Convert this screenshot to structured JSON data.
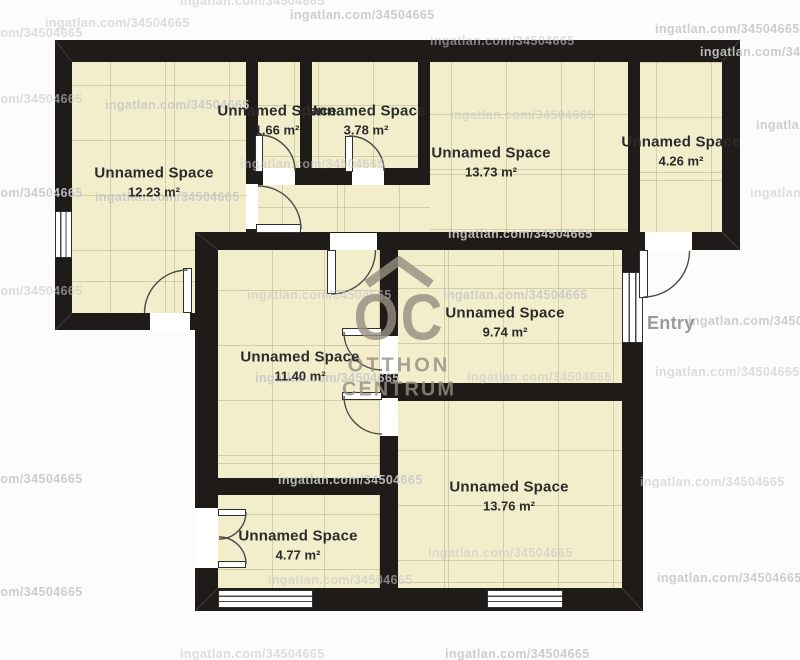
{
  "floorplan": {
    "entry_label": "Entry",
    "logo": {
      "monogram": "OC",
      "word1": "OTTHON",
      "word2": "CENTRUM"
    },
    "watermark": {
      "text": "ingatlan.com/34504665",
      "positions": [
        [
          180,
          -6
        ],
        [
          290,
          8
        ],
        [
          45,
          16
        ],
        [
          655,
          22
        ],
        [
          430,
          34
        ],
        [
          700,
          45
        ],
        [
          -62,
          26
        ],
        [
          105,
          98
        ],
        [
          450,
          108
        ],
        [
          756,
          118
        ],
        [
          -62,
          92
        ],
        [
          95,
          190
        ],
        [
          750,
          186
        ],
        [
          -62,
          186
        ],
        [
          240,
          157
        ],
        [
          448,
          227
        ],
        [
          247,
          288
        ],
        [
          443,
          288
        ],
        [
          -62,
          284
        ],
        [
          255,
          371
        ],
        [
          467,
          370
        ],
        [
          688,
          314
        ],
        [
          655,
          365
        ],
        [
          278,
          473
        ],
        [
          640,
          475
        ],
        [
          -62,
          472
        ],
        [
          428,
          546
        ],
        [
          657,
          571
        ],
        [
          268,
          573
        ],
        [
          445,
          647
        ],
        [
          180,
          647
        ],
        [
          -62,
          585
        ]
      ]
    },
    "rooms": [
      {
        "name": "Unnamed Space",
        "area": "12.23 m²",
        "label_cx": 154,
        "label_cy": 182,
        "floors": [
          [
            72,
            62,
            174,
            251
          ]
        ]
      },
      {
        "name": "Unnamed Space",
        "area": "1.66 m²",
        "label_cx": 277,
        "label_cy": 120,
        "floors": [
          [
            258,
            62,
            42,
            106
          ]
        ]
      },
      {
        "name": "Unnamed Space",
        "area": "3.78 m²",
        "label_cx": 366,
        "label_cy": 120,
        "floors": [
          [
            312,
            62,
            106,
            106
          ]
        ]
      },
      {
        "name": "Unnamed Space",
        "area": "13.73 m²",
        "label_cx": 491,
        "label_cy": 162,
        "floors": [
          [
            430,
            62,
            198,
            170
          ],
          [
            258,
            180,
            172,
            52
          ]
        ]
      },
      {
        "name": "Unnamed Space",
        "area": "4.26 m²",
        "label_cx": 681,
        "label_cy": 151,
        "floors": [
          [
            640,
            62,
            82,
            173
          ]
        ]
      },
      {
        "name": "Unnamed Space",
        "area": "11.40 m²",
        "label_cx": 300,
        "label_cy": 366,
        "floors": [
          [
            218,
            250,
            162,
            228
          ]
        ]
      },
      {
        "name": "Unnamed Space",
        "area": "9.74 m²",
        "label_cx": 505,
        "label_cy": 322,
        "floors": [
          [
            398,
            250,
            224,
            133
          ]
        ]
      },
      {
        "name": "Unnamed Space",
        "area": "4.77 m²",
        "label_cx": 298,
        "label_cy": 545,
        "floors": [
          [
            218,
            495,
            162,
            95
          ]
        ]
      },
      {
        "name": "Unnamed Space",
        "area": "13.76 m²",
        "label_cx": 509,
        "label_cy": 496,
        "floors": [
          [
            398,
            401,
            224,
            187
          ]
        ]
      }
    ],
    "colors": {
      "wall": "#1e1b18",
      "floor": "#f2edca",
      "grid": "#d8d2b3",
      "label": "#2b2b2b",
      "watermark": "#c9c9c9",
      "entry": "#9a9a9a",
      "logo": "#968e80"
    }
  }
}
